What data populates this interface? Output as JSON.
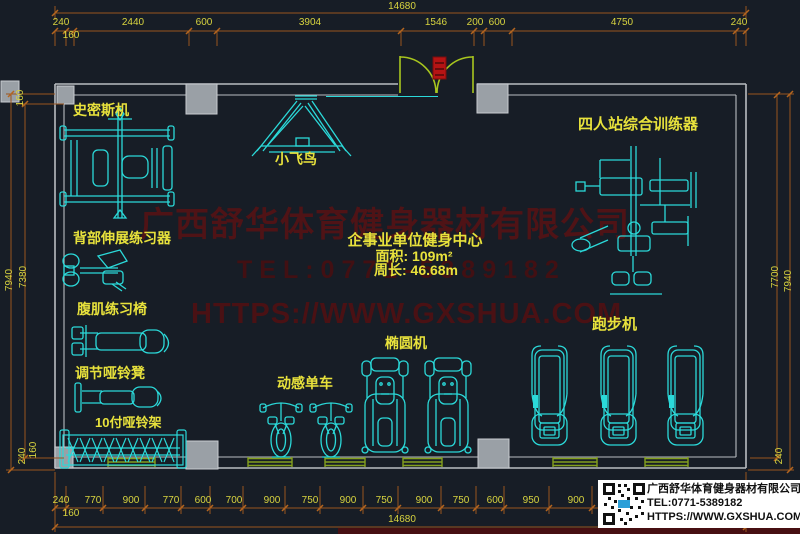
{
  "colors": {
    "background": "#171d26",
    "machine_cyan": "#2bd9d9",
    "dim_orange": "#9a551e",
    "dim_text_yellow": "#d8d43f",
    "label_yellow": "#e8e23c",
    "wall_gray": "#b9bdc1",
    "pillar_gray": "#9aa0a6",
    "door_green": "#a8c61e",
    "window_green": "#84a01e",
    "watermark_red": "#4f1316",
    "entry_marker_red": "#b51414"
  },
  "dimensions": {
    "top_total": "14680",
    "top_row": [
      "240",
      "2440",
      "600",
      "3904",
      "1546",
      "200",
      "600",
      "4750",
      "240"
    ],
    "top_offset": "160",
    "bottom_row": [
      "240",
      "770",
      "900",
      "770",
      "600",
      "700",
      "900",
      "750",
      "900",
      "750",
      "900",
      "750",
      "600",
      "950",
      "900"
    ],
    "bottom_offset": "160",
    "bottom_total": "14680",
    "left": [
      "160",
      "7940",
      "7380",
      "240",
      "160"
    ],
    "right": [
      "7700",
      "7940",
      "240"
    ]
  },
  "equipment": {
    "smith": "史密斯机",
    "back_extension": "背部伸展练习器",
    "ab_chair": "腹肌练习椅",
    "dumbbell_bench": "调节哑铃凳",
    "dumbbell_rack": "10付哑铃架",
    "fly_bird": "小飞鸟",
    "four_station": "四人站综合训练器",
    "spin_bike": "动感单车",
    "elliptical": "椭圆机",
    "treadmill": "跑步机"
  },
  "room_info": {
    "title": "企事业单位健身中心",
    "area": "面积: 109m²",
    "perimeter": "周长: 46.68m"
  },
  "watermark": {
    "line1": "广西舒华体育健身器材有限公司",
    "line2": "TEL:0771-5389182",
    "line3": "HTTPS://WWW.GXSHUA.COM"
  },
  "info_box": {
    "company": "广西舒华体育健身器材有限公司",
    "tel": "TEL:0771-5389182",
    "url": "HTTPS://WWW.GXSHUA.COM"
  }
}
